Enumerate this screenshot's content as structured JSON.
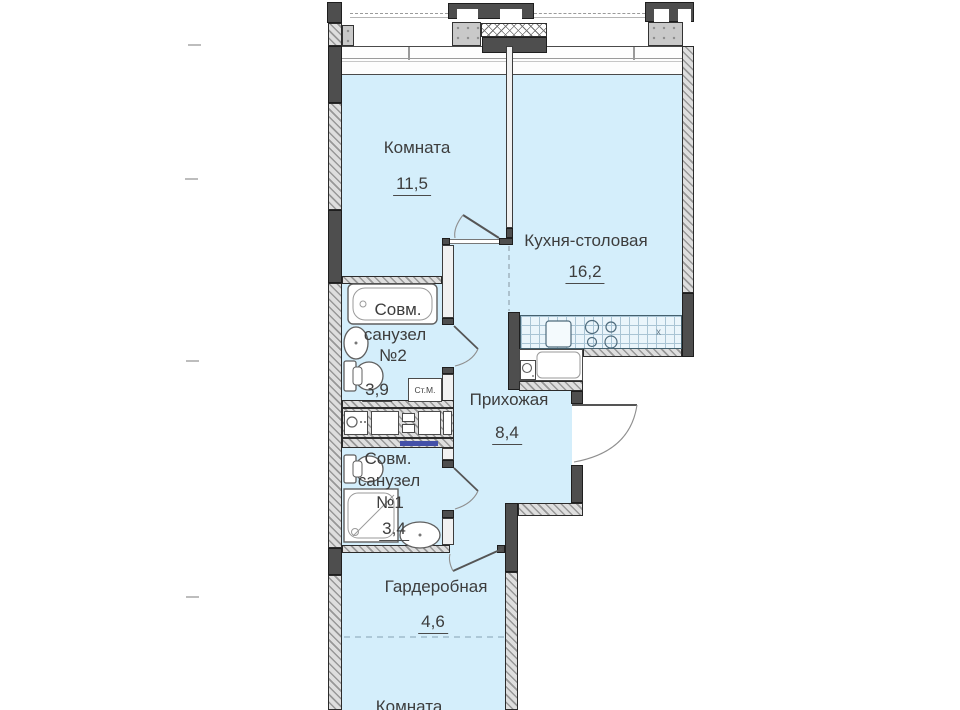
{
  "plan": {
    "title": "Apartment floor plan",
    "rooms": {
      "room_top": {
        "label": "Комната",
        "area": "11,5"
      },
      "kitchen": {
        "label": "Кухня-столовая",
        "area": "16,2"
      },
      "bathroom2": {
        "lines": [
          "Совм.",
          "санузел",
          "№2"
        ],
        "area": "3,9"
      },
      "hallway": {
        "label": "Прихожая",
        "area": "8,4"
      },
      "bathroom1": {
        "lines": [
          "Совм.",
          "санузел",
          "№1"
        ],
        "area": "3,4"
      },
      "wardrobe": {
        "label": "Гардеробная",
        "area": "4,6"
      },
      "room_bottom": {
        "label": "Комната"
      }
    },
    "annotations": {
      "washing_machine": "Ст.М.",
      "kitchen_mark": "x"
    },
    "colors": {
      "room_fill": "#d4eefb",
      "wall_dark": "#4e4e4e",
      "wall_hatch": "#979797",
      "lintel_accent": "#4350a8",
      "grid_line": "#a9c4d4"
    }
  }
}
